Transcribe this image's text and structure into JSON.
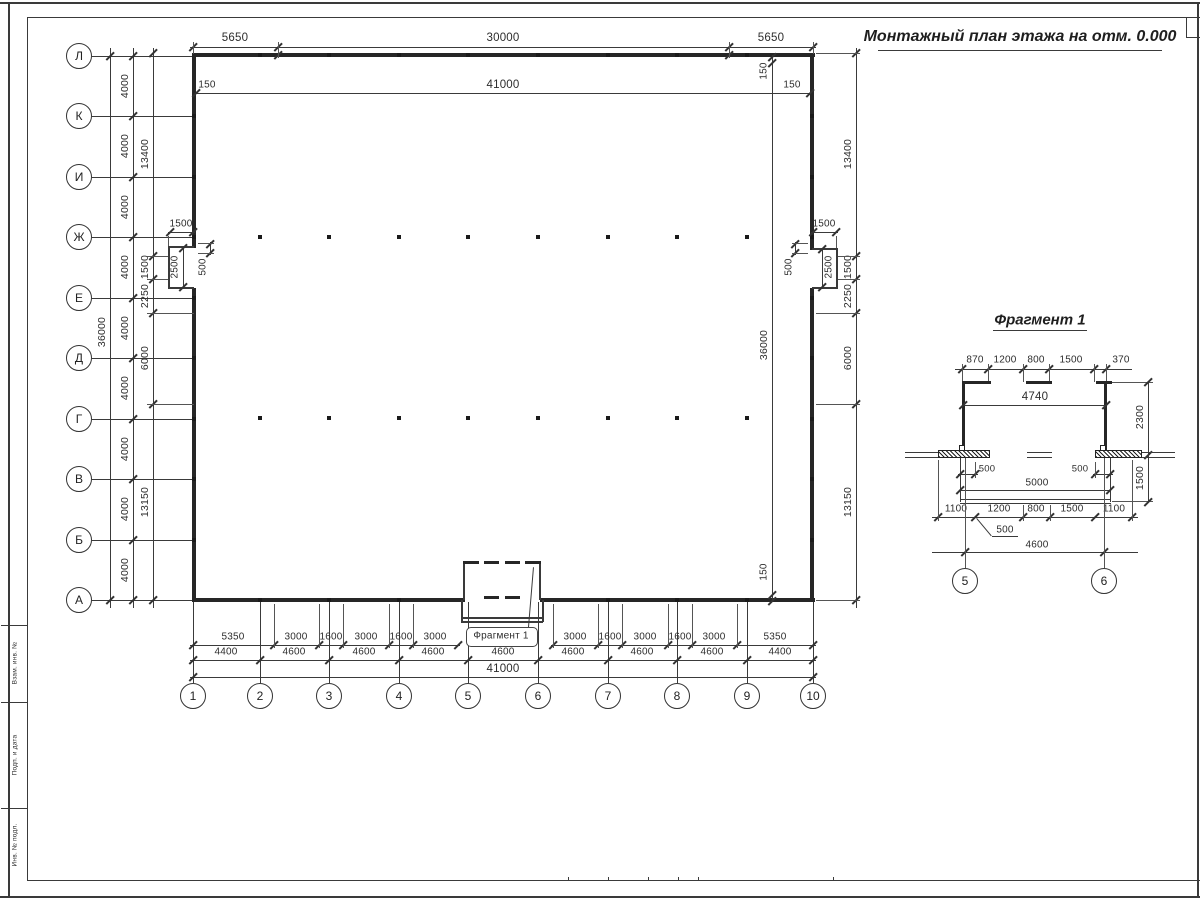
{
  "sheet": {
    "title": "Монтажный план этажа на отм. 0.000",
    "frame_strip_labels": [
      "Взам. инв. №",
      "Подп. и дата",
      "Инв. № подл."
    ]
  },
  "plan": {
    "axes_rows": [
      "Л",
      "К",
      "И",
      "Ж",
      "Е",
      "Д",
      "Г",
      "В",
      "Б",
      "А"
    ],
    "axes_cols": [
      "1",
      "2",
      "3",
      "4",
      "5",
      "6",
      "7",
      "8",
      "9",
      "10"
    ],
    "callout": "Фрагмент 1",
    "dims": {
      "top_chain": [
        "5650",
        "30000",
        "5650"
      ],
      "inner_top": [
        "150",
        "41000",
        "150"
      ],
      "left_overall": "36000",
      "left_step": "4000",
      "left_chain": [
        "13400",
        "1500",
        "2250",
        "6000",
        "13150"
      ],
      "right_chain": [
        "13400",
        "1500",
        "2250",
        "6000",
        "13150"
      ],
      "inner_right": [
        "150",
        "36000",
        "150"
      ],
      "niche": {
        "top": "1500",
        "depth": "2500",
        "offset": "500"
      },
      "bottom_row1_left": [
        "5350",
        "3000",
        "1600",
        "3000",
        "1600",
        "3000"
      ],
      "bottom_row1_right": [
        "3000",
        "1600",
        "3000",
        "1600",
        "3000",
        "5350"
      ],
      "bottom_row2": [
        "4400",
        "4600",
        "4600",
        "4600",
        "4600",
        "4600",
        "4600",
        "4600",
        "4400"
      ],
      "bottom_overall": "41000"
    }
  },
  "fragment": {
    "title": "Фрагмент 1",
    "axes": [
      "5",
      "6"
    ],
    "dims": {
      "top_chain": [
        "870",
        "1200",
        "800",
        "1500",
        "370"
      ],
      "opening": "4740",
      "height": "2300",
      "porch_width": "5000",
      "porch_depth": "1500",
      "offset_left": "500",
      "offset_right": "500",
      "bottom_chain": [
        "1100",
        "1200",
        "800",
        "1500",
        "1100"
      ],
      "leader": "500",
      "span": "4600"
    }
  }
}
